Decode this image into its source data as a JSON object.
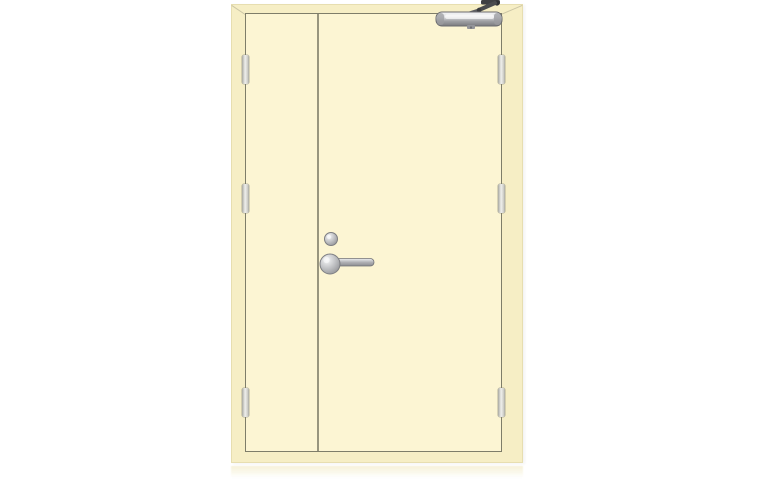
{
  "meta": {
    "kind": "product-photograph",
    "subject": "Unequal double-leaf steel fire door, cream finish, shown closed on a plain white studio background with a faint floor reflection",
    "visible_text": ""
  },
  "parts": {
    "frame": "Door frame with mitred corners",
    "inactive_leaf": "Narrow inactive door leaf (left)",
    "active_leaf": "Wide active door leaf (right)",
    "hinge": "Butt hinge (three per leaf)",
    "closer": "Overhead door closer with scissor arm, top of active leaf",
    "cylinder": "Round lock cylinder above handle",
    "handle": "Stainless lever handle on round rose",
    "reflection": "Soft floor reflection below door"
  },
  "counts": {
    "leaves": 2,
    "hinges_per_side": 3,
    "hinge_sides": [
      "left",
      "right"
    ]
  },
  "colors": {
    "background": "#ffffff",
    "frame": "#f6eec5",
    "frame-edge": "#e7deb0",
    "leaf": "#fcf5d3",
    "outline": "#7e7d69",
    "hinge-light": "#efefec",
    "hinge-mid": "#cfcfc9",
    "hinge-dark": "#a8a8a0",
    "metal-bright": "#f5f6f7",
    "metal-mid": "#b8b9bc",
    "metal-dark": "#7a7b7f",
    "metal-edge": "#54555a",
    "arm-dark": "#3f4043",
    "reflection": "#f3ecc8"
  }
}
